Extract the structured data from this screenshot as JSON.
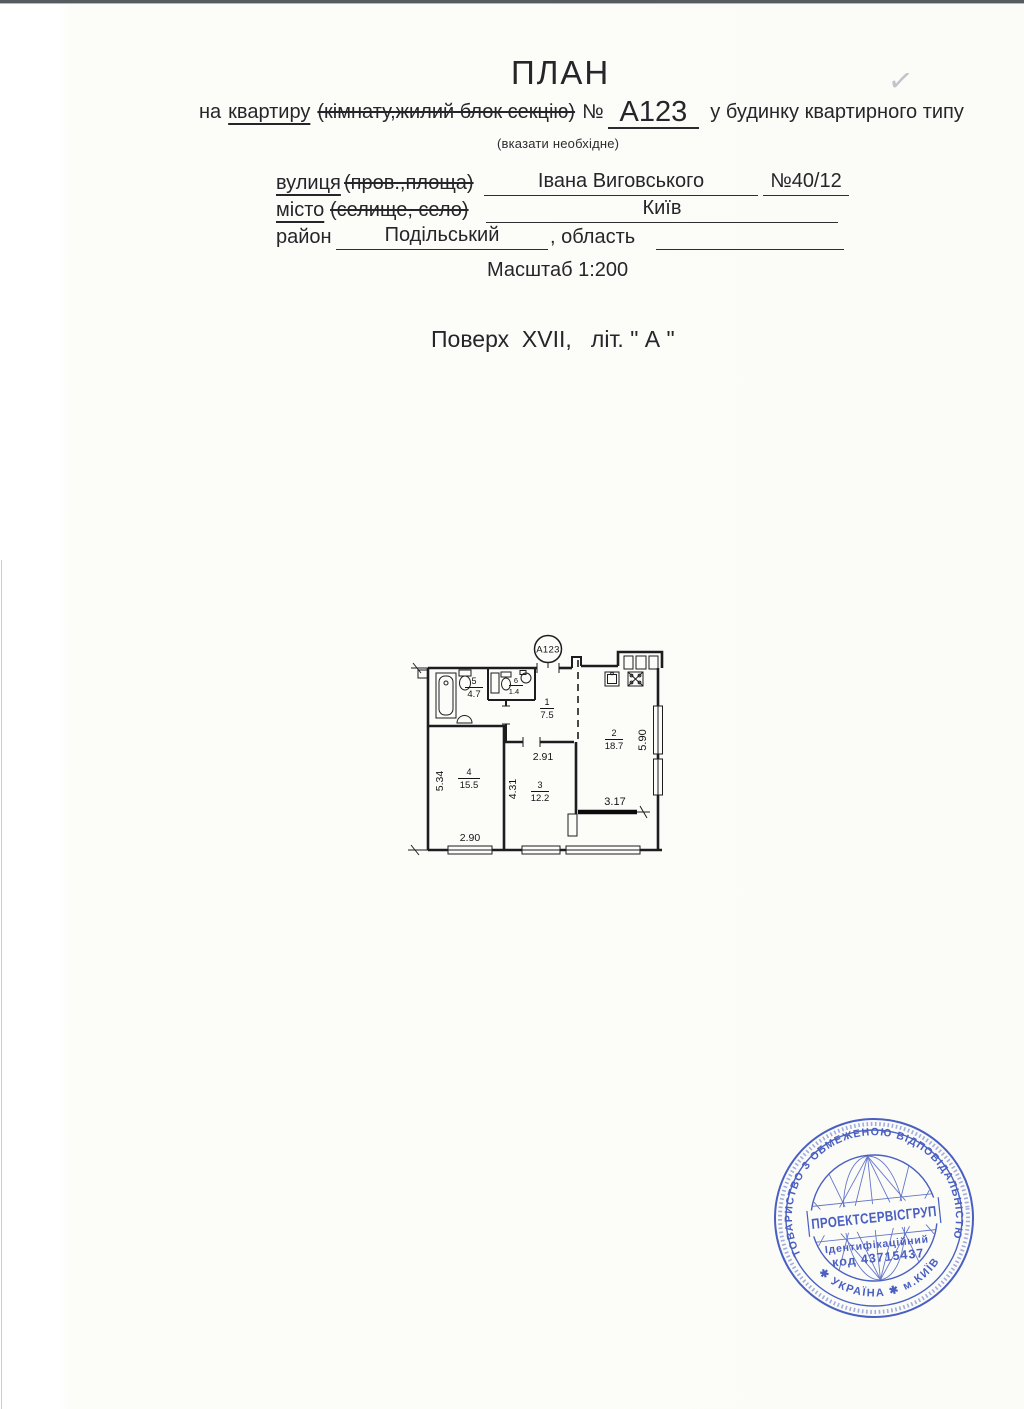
{
  "document": {
    "title": "ПЛАН",
    "subtitle": {
      "prefix": "на",
      "selected_option": "квартиру",
      "struck_options": "(кімнату,жилий блок секцію)",
      "numero_sign": "№",
      "apartment_number": "А123",
      "suffix": "у будинку квартирного типу",
      "note": "(вказати необхідне)"
    },
    "address": {
      "street_label": "вулиця",
      "street_struck": "(пров.,площа)",
      "street_value": "Івана Виговського",
      "house_number": "№40/12",
      "city_label": "місто",
      "city_struck": "(селище, село)",
      "city_value": "Київ",
      "district_label": "район",
      "district_value": "Подільський",
      "oblast_label": ", область"
    },
    "scale": "Масштаб 1:200",
    "floor_line": "Поверх  XVII,   літ. \" А \"",
    "checkmark": "✓"
  },
  "plan": {
    "tag": "А123",
    "rooms": {
      "r1": {
        "num": "1",
        "area": "7.5"
      },
      "r2": {
        "num": "2",
        "area": "18.7"
      },
      "r3": {
        "num": "3",
        "area": "12.2"
      },
      "r4": {
        "num": "4",
        "area": "15.5"
      },
      "r5": {
        "num": "5",
        "area": "4.7"
      },
      "r6": {
        "num": "6",
        "area": "1.4"
      }
    },
    "dims": {
      "left_vertical": "5.34",
      "room4_bottom": "2.90",
      "room3_vertical": "4.31",
      "room3_top": "2.91",
      "balcony": "3.17",
      "right_vertical": "5.90"
    }
  },
  "stamp": {
    "arc_top": "ТОВАРИСТВО З ОБМЕЖЕНОЮ ВІДПОВІДАЛЬНІСТЮ",
    "arc_bottom": "✱ УКРАЇНА ✱ м.КИЇВ",
    "company": "ПРОЕКТСЕРВІСГРУП",
    "id_label": "Ідентифікаційний",
    "id_code": "код 43715437",
    "color": "#3c54bd"
  }
}
